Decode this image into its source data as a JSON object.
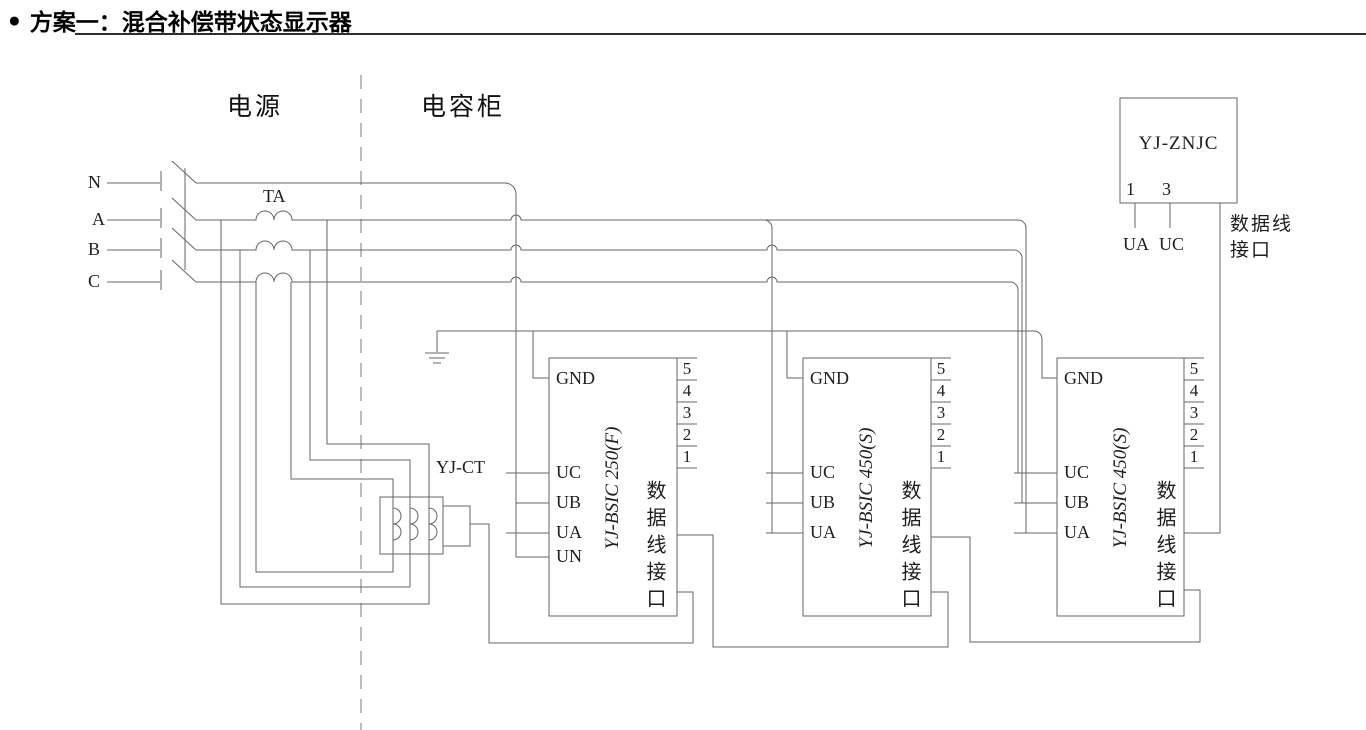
{
  "title": {
    "bullet": "●",
    "text": "方案一：混合补偿带状态显示器"
  },
  "zones": {
    "power": "电源",
    "capacitor": "电容柜"
  },
  "phases": {
    "n": "N",
    "a": "A",
    "b": "B",
    "c": "C"
  },
  "transformer_label": "TA",
  "ct_label": "YJ-CT",
  "controllers": [
    {
      "model": "YJ-BSIC 250(F)",
      "gnd": "GND",
      "uc": "UC",
      "ub": "UB",
      "ua": "UA",
      "un": "UN",
      "pins": [
        "5",
        "4",
        "3",
        "2",
        "1"
      ],
      "port": "数据线接口"
    },
    {
      "model": "YJ-BSIC 450(S)",
      "gnd": "GND",
      "uc": "UC",
      "ub": "UB",
      "ua": "UA",
      "pins": [
        "5",
        "4",
        "3",
        "2",
        "1"
      ],
      "port": "数据线接口"
    },
    {
      "model": "YJ-BSIC 450(S)",
      "gnd": "GND",
      "uc": "UC",
      "ub": "UB",
      "ua": "UA",
      "pins": [
        "5",
        "4",
        "3",
        "2",
        "1"
      ],
      "port": "数据线接口"
    }
  ],
  "monitor": {
    "model": "YJ-ZNJC",
    "pin_1": "1",
    "pin_3": "3",
    "ua": "UA",
    "uc": "UC",
    "port_line1": "数据线",
    "port_line2": "接口"
  },
  "colors": {
    "line": "#666666",
    "text": "#1e1e1e",
    "title": "#000000",
    "background": "#ffffff"
  }
}
